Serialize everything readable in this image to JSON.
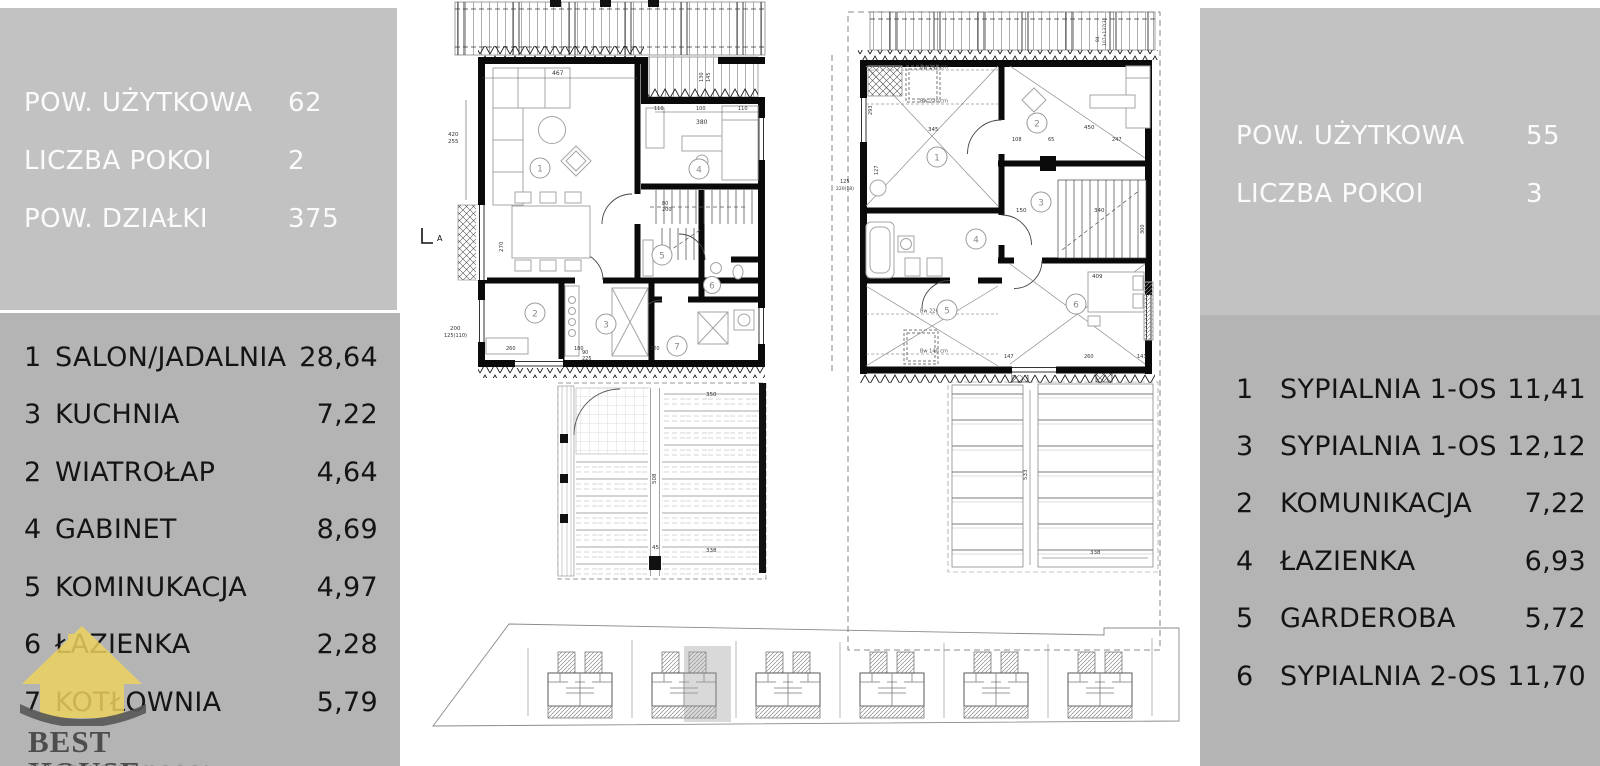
{
  "left_panel": {
    "stats": [
      {
        "label": "POW. UŻYTKOWA",
        "value": "62"
      },
      {
        "label": "LICZBA POKOI",
        "value": "2"
      },
      {
        "label": "POW. DZIAŁKI",
        "value": "375"
      }
    ],
    "rooms": [
      {
        "no": "1",
        "name": "SALON/JADALNIA",
        "area": "28,64"
      },
      {
        "no": "3",
        "name": "KUCHNIA",
        "area": "7,22"
      },
      {
        "no": "2",
        "name": "WIATROŁAP",
        "area": "4,64"
      },
      {
        "no": "4",
        "name": "GABINET",
        "area": "8,69"
      },
      {
        "no": "5",
        "name": "KOMINUKACJA",
        "area": "4,97"
      },
      {
        "no": "6",
        "name": "ŁAZIENKA",
        "area": "2,28"
      },
      {
        "no": "7",
        "name": "KOTŁOWNIA",
        "area": "5,79"
      }
    ]
  },
  "right_panel": {
    "stats": [
      {
        "label": "POW. UŻYTKOWA",
        "value": "55"
      },
      {
        "label": "LICZBA POKOI",
        "value": "3"
      }
    ],
    "rooms": [
      {
        "no": "1",
        "name": "SYPIALNIA 1-OS",
        "area": "11,41"
      },
      {
        "no": "3",
        "name": "SYPIALNIA 1-OS",
        "area": "12,12"
      },
      {
        "no": "2",
        "name": "KOMUNIKACJA",
        "area": "7,22"
      },
      {
        "no": "4",
        "name": "ŁAZIENKA",
        "area": "6,93"
      },
      {
        "no": "5",
        "name": "GARDEROBA",
        "area": "5,72"
      },
      {
        "no": "6",
        "name": "SYPIALNIA 2-OS",
        "area": "11,70"
      }
    ]
  },
  "logo": {
    "title": "BEST HOUSE",
    "subtitle": "NIERUCHOMOŚCI"
  },
  "plan_labels": {
    "floor1": [
      "1",
      "2",
      "3",
      "4",
      "5",
      "6",
      "7"
    ],
    "floor2": [
      "1",
      "2",
      "3",
      "4",
      "5",
      "6"
    ]
  },
  "section_label": "A",
  "dims": {
    "f1": [
      "467",
      "420",
      "255",
      "270",
      "200",
      "125(110)",
      "380",
      "110",
      "100",
      "110",
      "130",
      "145",
      "80",
      "200",
      "90",
      "225",
      "260",
      "180",
      "320"
    ],
    "deck1": [
      "350",
      "508",
      "45",
      "338"
    ],
    "f2": [
      "345",
      "450",
      "108",
      "65",
      "247",
      "293",
      "127",
      "150",
      "340",
      "300",
      "409",
      "147",
      "260",
      "143",
      "125",
      "220(18)",
      "84",
      "107+137(3)"
    ],
    "bw": [
      "Bw 140 cm",
      "Bw 220 cm",
      "Bw 220 cm",
      "Bw 140 cm"
    ],
    "deck2": [
      "533",
      "338"
    ]
  },
  "site_plan": {
    "house_count": "6"
  },
  "colors": {
    "panel_light": "#c2c2c2",
    "panel_dark": "#b4b4b4",
    "accent_yellow": "#eed25e",
    "logo_text": "#4d4d4d",
    "logo_sub": "#979797",
    "swoosh": "#575757",
    "wall": "#0a0a0a"
  }
}
